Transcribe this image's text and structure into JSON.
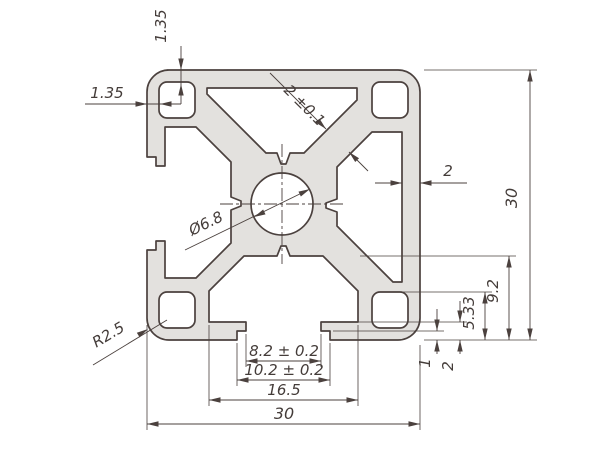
{
  "drawing": {
    "type": "aluminium-extrusion-profile-cross-section",
    "colors": {
      "background": "#ffffff",
      "profile_fill": "#e3e1de",
      "line": "#4b413e"
    },
    "dimensions": {
      "wall_top": "1.35",
      "wall_left": "1.35",
      "web_thickness": "2 ±0.1",
      "wall_right": "2",
      "profile_height": "30",
      "slot_depth": "9.2",
      "hole_to_face": "5.33",
      "lip_height": "2",
      "recess_depth": "1",
      "slot_opening": "8.2 ± 0.2",
      "slot_recess_width": "10.2 ± 0.2",
      "slot_inner_width": "16.5",
      "profile_width": "30",
      "corner_radius": "R2.5",
      "center_hole": "Ø6.8"
    }
  }
}
